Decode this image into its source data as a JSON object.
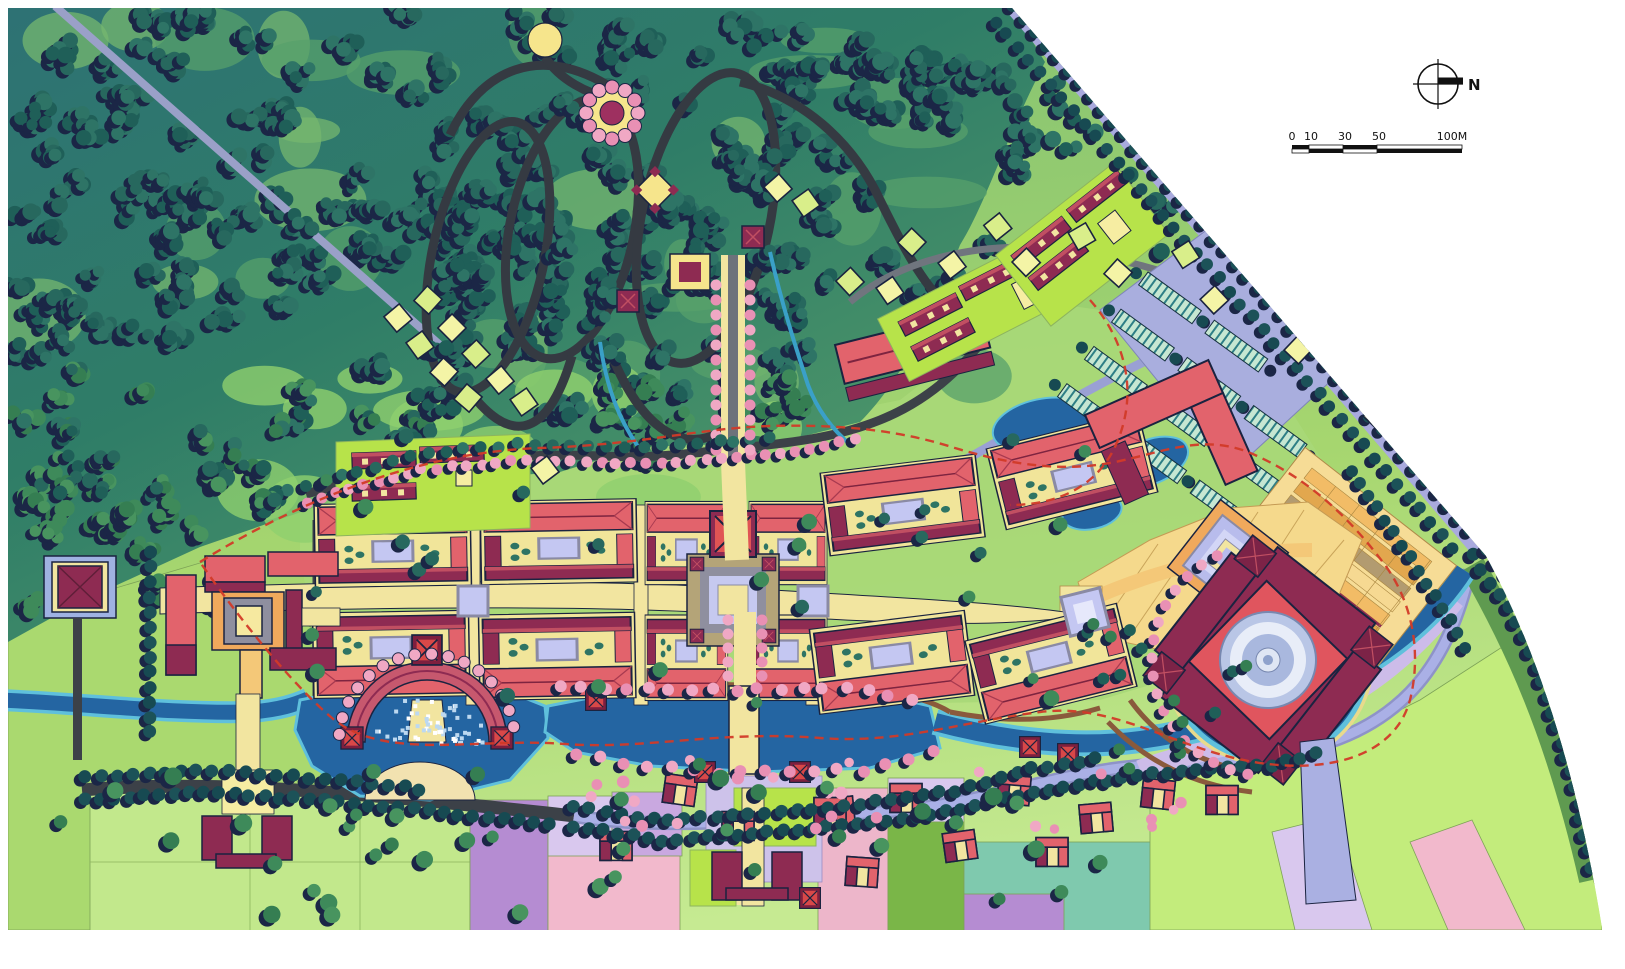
{
  "map": {
    "type": "site-master-plan",
    "annotations": {
      "north_label": "N",
      "scale_ticks": [
        "0",
        "10",
        "30",
        "50",
        "100M"
      ]
    },
    "palette": {
      "paper": "#ffffff",
      "forest_teal_bg": "#2f7d67",
      "tree_dark_teal": "#1f5f58",
      "tree_shadow_navy": "#1b2646",
      "tree_green": "#3e8a5a",
      "tree_pink": "#f0a8c4",
      "meadow_green": "#8fc878",
      "field_light_green": "#c3ec7c",
      "field_lime": "#b7e34a",
      "field_pink": "#f2b9cc",
      "field_purple": "#b58cd2",
      "field_lavender": "#d9c8ee",
      "field_teal": "#7fc9ae",
      "water_blue": "#2465a2",
      "water_edge_cyan": "#5fc0dc",
      "road_dark": "#3c4148",
      "road_lavender": "#a9aade",
      "roof_salmon": "#e2636c",
      "roof_maroon": "#8e2b52",
      "path_yellow": "#f2e5a0",
      "court_lavender": "#c4c7f2",
      "courtyard_orange": "#f0a95c",
      "terrace_orange": "#f2bc66",
      "terrace_tan": "#b29b70",
      "cabin_yellow": "#f4f4a6",
      "dome_blue_gray": "#b9c6e6",
      "boundary_dashed_red": "#d23a28",
      "ink": "#111111"
    },
    "features": [
      "forest-park",
      "garden-loop-trails",
      "flower-ring-plaza",
      "hilltop-pavilion",
      "cabin-clusters",
      "ceremonial-approach",
      "main-axis-courtyard-complex",
      "grand-central-court",
      "west-gate-compound",
      "gate-tower",
      "amphitheater-pond",
      "south-gate",
      "village-farmhouses",
      "field-patchwork",
      "river-and-ponds",
      "circular-moat-dome-hall",
      "terraced-fields",
      "grand-plaza",
      "parking-lot",
      "boundary-road",
      "site-boundary-dashed-line",
      "north-arrow",
      "scale-bar"
    ]
  }
}
